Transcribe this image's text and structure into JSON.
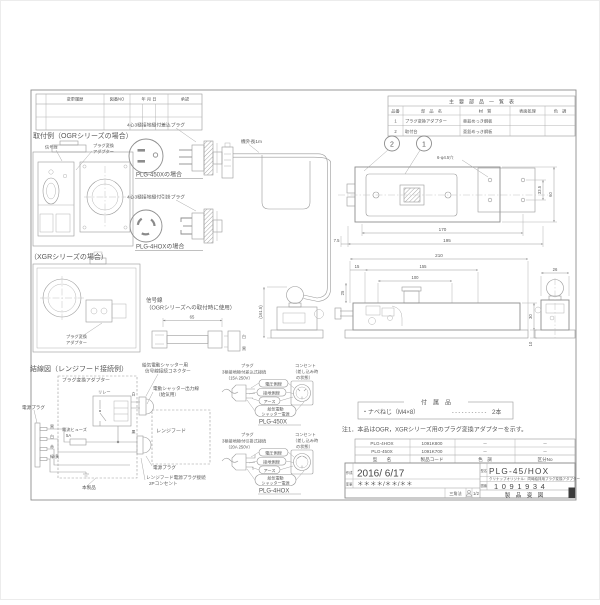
{
  "revision_table": {
    "headers": [
      "変更履歴",
      "図番NO",
      "年 月 日",
      "承認"
    ]
  },
  "parts_table": {
    "title": "主　要　部　品　一　覧　表",
    "headers": [
      "品番",
      "部　品　名",
      "材　質",
      "表面処理",
      "色　調"
    ],
    "rows": [
      {
        "no": "1",
        "name": "プラグ変換アダプター",
        "material": "亜鉛めっき鋼板"
      },
      {
        "no": "2",
        "name": "取付台",
        "material": "亜鉛めっき鋼板"
      }
    ]
  },
  "install_ogr": {
    "title": "取付例（OGRシリーズの場合）",
    "signal_label": "信号線",
    "adapter_l1": "プラグ変換",
    "adapter_l2": "アダプター"
  },
  "install_xgr": {
    "title": "（XGRシリーズの場合）",
    "adapter_l1": "プラグ変換",
    "adapter_l2": "アダプター"
  },
  "plug_450x": {
    "label": "4心3極接地極付差込プラグ",
    "caption": "PLG-450Xの場合"
  },
  "plug_4hox": {
    "label": "4心3極接地極付引掛プラグ",
    "caption": "PLG-4HOXの場合"
  },
  "cable": {
    "length_label": "機外長1m"
  },
  "signal_line": {
    "title_l1": "信号線",
    "title_l2": "（OGRシリーズへの取付時に使用）",
    "dim": "65",
    "wire_a": "白",
    "wire_b": "黒"
  },
  "wiring": {
    "title": "結線図（レンジフード接続例）",
    "adapter_label": "プラグ変換アダプター",
    "relay_label": "リレー",
    "fuse_l1": "電流ヒューズ",
    "fuse_l2": "5A",
    "plug_left_label": "電源プラグ",
    "wire1": "黒",
    "wire2": "白",
    "wire3": "赤",
    "wire4": "緑/黄",
    "wire_white": "白",
    "wire_black": "黒",
    "connector_l1": "給気電動シャッター用",
    "connector_l2": "信号線接続コネクター",
    "shutter_out_l1": "電動シャッター出力線",
    "shutter_out_l2": "（給気用）",
    "rangehood_label": "レンジフード",
    "plug_right_label": "電源プラグ",
    "outlet_l1": "レンジフード電源プラグ接続",
    "outlet_l2": "2Pコンセント",
    "product_label": "本製品"
  },
  "pinout_450x": {
    "plug_l1": "プラグ",
    "plug_l2": "3極接地極付差込式接続",
    "plug_l3": "（15A 250V）",
    "outlet_l1": "コンセント",
    "outlet_l2": "（差し込み時",
    "outlet_l3": "の状態）",
    "oval_hot": "電圧側線",
    "oval_neutral": "接地側線",
    "oval_earth": "アース",
    "oval_shutter_l1": "給気電動",
    "oval_shutter_l2": "シャッター電源",
    "caption": "PLG-450X"
  },
  "pinout_4hox": {
    "plug_l1": "プラグ",
    "plug_l2": "3極接地極付引掛式接続",
    "plug_l3": "（20A 250V）",
    "outlet_l1": "コンセント",
    "outlet_l2": "（差し込み時",
    "outlet_l3": "の状態）",
    "oval_hot": "電圧側線",
    "oval_neutral": "接地側線",
    "oval_earth": "アース",
    "oval_shutter_l1": "給気電動",
    "oval_shutter_l2": "シャッター電源",
    "caption": "PLG-4HOX"
  },
  "views": {
    "balloon_1": "1",
    "balloon_2": "2",
    "top_holes": "6-φ4.5穴",
    "top_height_inner": "33.5",
    "top_height": "60",
    "top_width_inner": "170",
    "top_width": "195",
    "top_offset": "7.5",
    "front_width": "210",
    "front_offset": "15",
    "front_inner": "155",
    "front_left": "25",
    "front_pitch": "100",
    "front_height": "30",
    "front_base": "10",
    "side_width": "26",
    "adapter_height": "(161.5)"
  },
  "accessories": {
    "title": "付　属　品",
    "item": "・ナベねじ（M4×8）",
    "dots": "-----------",
    "qty": "2本"
  },
  "note": {
    "text": "注1．本品はOGR，XGRシリーズ用のプラグ変換アダプターを示す。"
  },
  "model_table": {
    "headers": [
      "型　　名",
      "製品コード",
      "色　調",
      "区分No"
    ],
    "rows": [
      {
        "model": "PLG-4HOX",
        "code": "1091K800",
        "color": "－",
        "cls": "－"
      },
      {
        "model": "PLG-450X",
        "code": "1091K700",
        "color": "－",
        "cls": "－"
      }
    ]
  },
  "title_block": {
    "created_label": "作成",
    "created_date": "2016/ 6/17",
    "revised_label": "変更",
    "revised_date": "＊＊＊＊/＊＊/＊＊",
    "projection_label": "三角法",
    "scale": "1/2",
    "model_label": "型名",
    "model": "PLG-45/HOX",
    "subtitle": "クリナップオリジナル：同時給排用プラグ変換アダプター",
    "number_label": "図番",
    "number": "1091934",
    "doc_type": "製　品　姿　図"
  }
}
